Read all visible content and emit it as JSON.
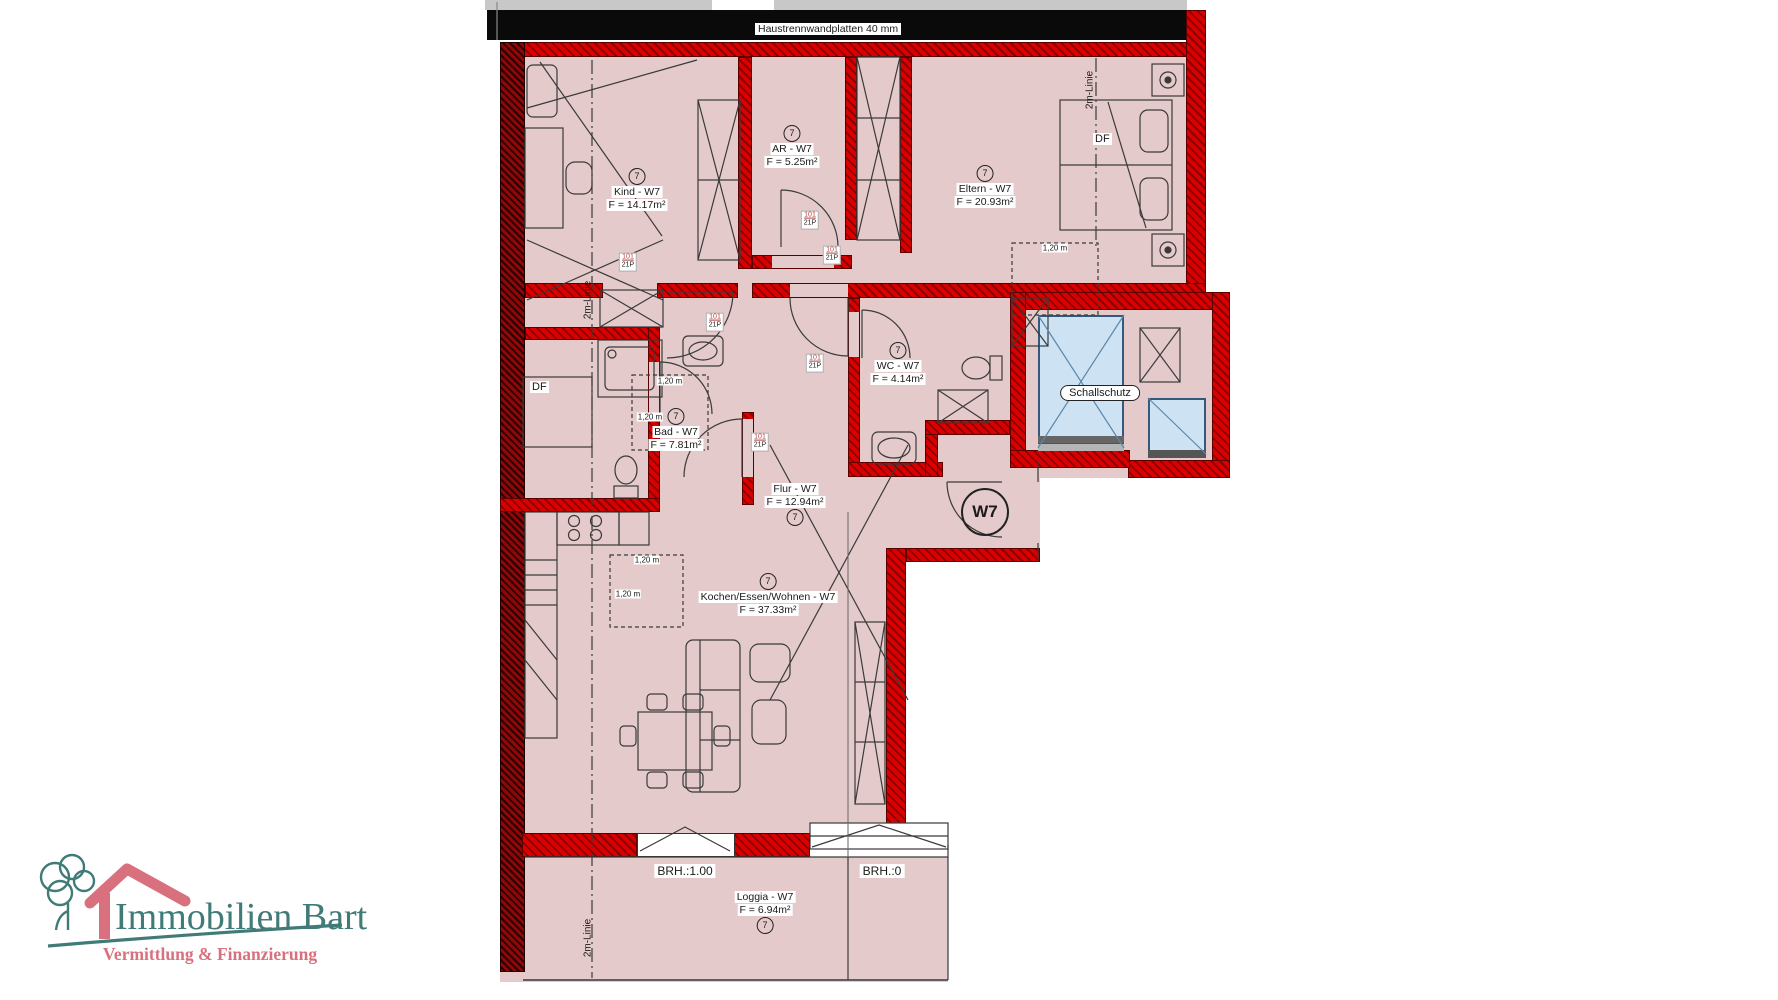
{
  "title_bar": {
    "haustrennwand_label": "Haustrennwandplatten 40 mm"
  },
  "apartment": {
    "unit_circle_label": "W7"
  },
  "rooms": [
    {
      "key": "kind",
      "unit": "7",
      "name": "Kind - W7",
      "area": "F = 14.17m²"
    },
    {
      "key": "ar",
      "unit": "7",
      "name": "AR - W7",
      "area": "F = 5.25m²"
    },
    {
      "key": "eltern",
      "unit": "7",
      "name": "Eltern - W7",
      "area": "F = 20.93m²"
    },
    {
      "key": "bad",
      "unit": "7",
      "name": "Bad - W7",
      "area": "F = 7.81m²"
    },
    {
      "key": "wc",
      "unit": "7",
      "name": "WC - W7",
      "area": "F = 4.14m²"
    },
    {
      "key": "flur",
      "unit": "7",
      "name": "Flur - W7",
      "area": "F = 12.94m²"
    },
    {
      "key": "kochen",
      "unit": "7",
      "name": "Kochen/Essen/Wohnen - W7",
      "area": "F = 37.33m²"
    },
    {
      "key": "loggia",
      "unit": "7",
      "name": "Loggia - W7",
      "area": "F = 6.94m²"
    }
  ],
  "annotations": {
    "schallschutz": "Schallschutz",
    "df": "DF",
    "zwei_m_linie": "2m-Linie",
    "brh_100": "BRH.:1.00",
    "brh_0": "BRH.:0",
    "dim_120": "1,20 m",
    "door_tag_top": "101",
    "door_tag_bottom": "21P"
  },
  "logo": {
    "name": "Immobilien Bart",
    "tagline": "Vermittlung & Finanzierung"
  },
  "colors": {
    "wall_red": "#d40000",
    "wall_dark": "#4a0000",
    "room_fill": "#e4caca",
    "glazing_blue": "#cde3f4",
    "logo_teal": "#407b77",
    "logo_pink": "#d9707d"
  }
}
